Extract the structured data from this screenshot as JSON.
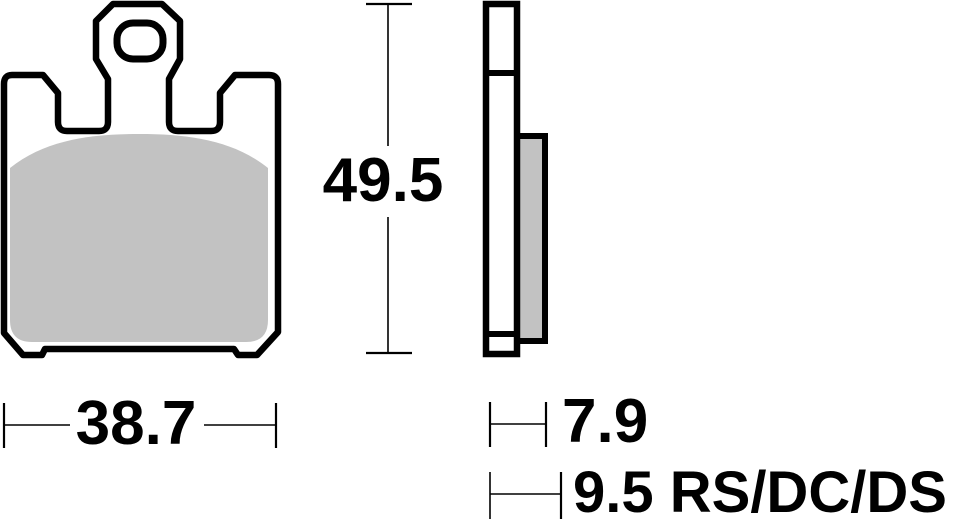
{
  "drawing": {
    "dimensions": {
      "width": "38.7",
      "height": "49.5",
      "thickness": "7.9",
      "thickness_alt": "9.5 RS/DC/DS"
    },
    "colors": {
      "line": "#000000",
      "friction": "#c2c2c2",
      "background": "#ffffff"
    }
  }
}
